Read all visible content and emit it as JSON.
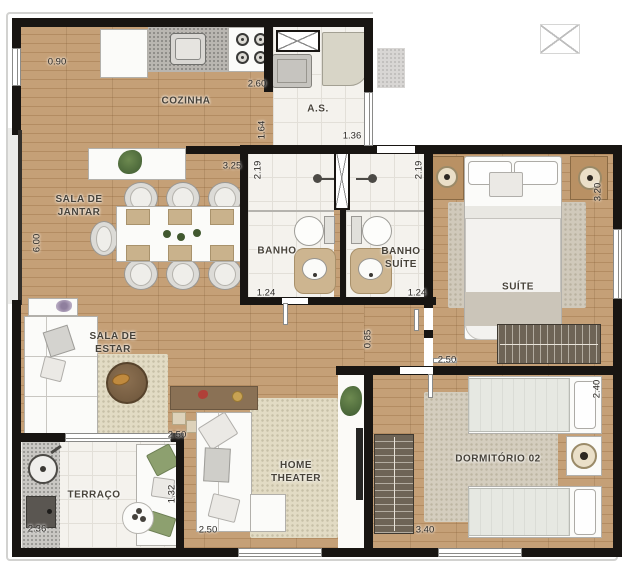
{
  "rooms": {
    "cozinha": "COZINHA",
    "as": "A.S.",
    "sala_jantar": "SALA DE\nJANTAR",
    "banho": "BANHO",
    "banho_suite": "BANHO\nSUÍTE",
    "suite": "SUÍTE",
    "sala_estar": "SALA DE\nESTAR",
    "home_theater": "HOME\nTHEATER",
    "terraco": "TERRAÇO",
    "dormitorio_02": "DORMITÓRIO 02"
  },
  "dims": {
    "kitchen_wall": "0.90",
    "cozinha_width": "2.60",
    "cozinha_depth": "1.64",
    "as_width": "1.36",
    "jantar_width": "3.25",
    "banho_depth": "2.19",
    "banho_suite_depth": "2.19",
    "sala_length": "6.00",
    "banho_width": "1.24",
    "banho_suite_width": "1.24",
    "suite_depth": "3.20",
    "hall_width": "0.85",
    "suite_width": "2.50",
    "dorm_depth": "2.40",
    "dorm_width": "3.40",
    "estar_width": "2.50",
    "ht_width": "2.50",
    "terraco_width": "2.36",
    "terraco_depth": "1.32"
  },
  "colors": {
    "wood": "#c09a6f",
    "wall": "#181512",
    "tile": "#f4f2ed",
    "rug": "#e2dbc4",
    "cushion_green": "#8da06f"
  }
}
